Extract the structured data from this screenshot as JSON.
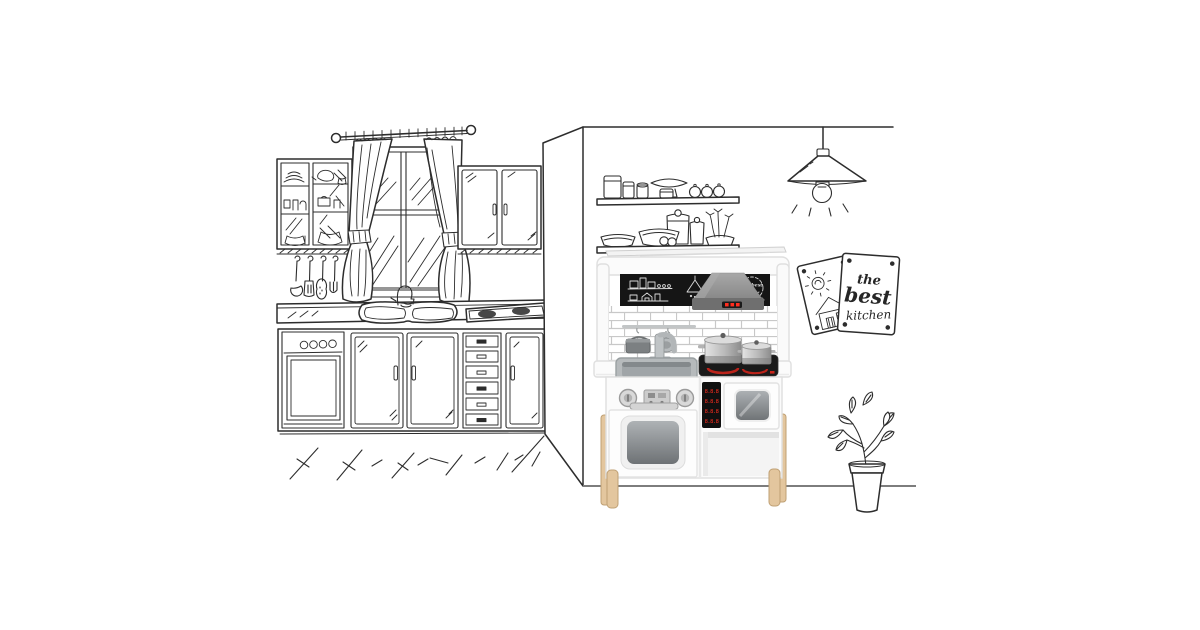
{
  "scene": {
    "background_color": "#ffffff",
    "style": "hand-drawn kitchen sketch with a photographed wooden toy play kitchen on the right wall"
  },
  "colors": {
    "ink": "#2d2d2d",
    "floor_line": "#7d7d7d",
    "chalkboard": "#151515",
    "chalk": "#dadada",
    "hood_gray": "#9a9a9a",
    "hood_dark": "#6f6f6f",
    "led_red": "#ff2d1e",
    "burner_red": "#c9241a",
    "steel_light": "#d8d8d8",
    "steel_dark": "#8f9496",
    "sink_gray": "#a0a5a8",
    "brick_mortar": "#c8c8c8",
    "product_white": "#fbfbfb",
    "product_line": "#dfdfdf",
    "cooktop_black": "#1a1a1a",
    "wood": "#e3c69e",
    "wood_line": "#bfa074"
  },
  "pinned_cards": {
    "front_card": {
      "line1": "the",
      "line2": "best",
      "line3": "kitchen"
    }
  },
  "toy_kitchen": {
    "chalkboard_badge_text": "the best",
    "hood_led_dots": 3,
    "control_panel_rows": [
      "8.8.8",
      "8.8.8",
      "8.8.8",
      "8.8.8"
    ]
  },
  "sketch_elements": {
    "left_room": [
      "glass-front upper cabinet with dishes",
      "window with tied curtains",
      "double upper cabinet",
      "hanging utensils",
      "double sink with gooseneck faucet",
      "hatched cooktop",
      "oven with four knobs",
      "two cabinet doors",
      "six-drawer stack",
      "cabinet door",
      "floor strokes"
    ],
    "right_wall": [
      "ceiling line",
      "pendant lamp",
      "two shelves with jars and bowls",
      "two pinned cards",
      "potted plant",
      "floor line"
    ]
  }
}
